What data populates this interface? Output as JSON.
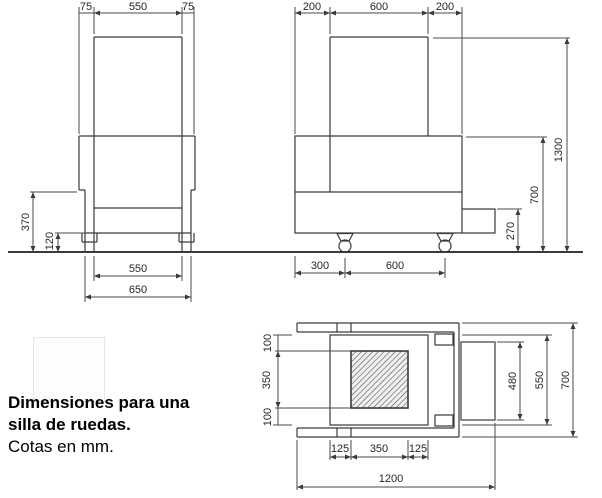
{
  "caption": {
    "title_line1": "Dimensiones para una",
    "title_line2": "silla de ruedas.",
    "subtitle": "Cotas en mm."
  },
  "front_view": {
    "top": {
      "left": "75",
      "mid": "550",
      "right": "75"
    },
    "left": {
      "seat_height": "370",
      "wheel_height": "120"
    },
    "bottom": {
      "inner_width": "550",
      "outer_width": "650"
    }
  },
  "side_view": {
    "top": {
      "left": "200",
      "mid": "600",
      "right": "200"
    },
    "right": {
      "total_height": "1300",
      "seat_height": "700",
      "footrest_height": "270"
    },
    "bottom": {
      "front_offset": "300",
      "wheelbase": "600"
    }
  },
  "top_view": {
    "left": {
      "a": "100",
      "b": "350",
      "c": "100"
    },
    "right": {
      "footplate": "480",
      "seat_frame": "550",
      "overall": "700"
    },
    "bottom": {
      "a": "125",
      "b": "350",
      "c": "125",
      "overall_length": "1200"
    }
  }
}
